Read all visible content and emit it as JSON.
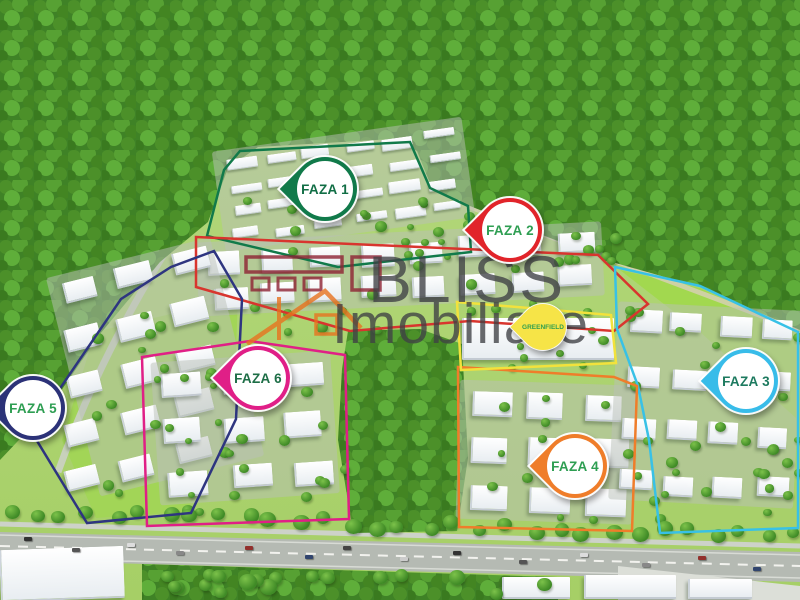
{
  "map": {
    "description": "Aerial masterplan render of Greenfield residential complex with phase markers",
    "watermark": {
      "brand": "BLISS",
      "brand2": "Imobiliare"
    },
    "phases": [
      {
        "id": "faza-1",
        "label": "FAZA 1",
        "pin_color": "#117a4a",
        "label_color": "#116e45",
        "boundary_color": "#117a4a",
        "pin_tip": {
          "x": 325,
          "y": 234
        },
        "boundary": [
          [
            240,
            151
          ],
          [
            410,
            142
          ],
          [
            430,
            188
          ],
          [
            468,
            206
          ],
          [
            471,
            252
          ],
          [
            338,
            267
          ],
          [
            207,
            236
          ],
          [
            224,
            170
          ]
        ]
      },
      {
        "id": "faza-2",
        "label": "FAZA 2",
        "pin_color": "#e1242a",
        "label_color": "#2e9e52",
        "boundary_color": "#d8352e",
        "pin_tip": {
          "x": 510,
          "y": 275
        },
        "boundary": [
          [
            196,
            237
          ],
          [
            598,
            255
          ],
          [
            648,
            304
          ],
          [
            614,
            331
          ],
          [
            470,
            321
          ],
          [
            350,
            331
          ],
          [
            196,
            287
          ]
        ]
      },
      {
        "id": "faza-3",
        "label": "FAZA 3",
        "pin_color": "#38bce9",
        "label_color": "#1d7a5f",
        "boundary_color": "#38c1e6",
        "pin_tip": {
          "x": 746,
          "y": 426
        },
        "boundary": [
          [
            615,
            267
          ],
          [
            700,
            286
          ],
          [
            798,
            332
          ],
          [
            798,
            528
          ],
          [
            660,
            533
          ],
          [
            649,
            440
          ],
          [
            638,
            386
          ],
          [
            617,
            329
          ]
        ]
      },
      {
        "id": "faza-4",
        "label": "FAZA 4",
        "pin_color": "#ef7d2a",
        "label_color": "#2e9e52",
        "boundary_color": "#ef7d2a",
        "pin_tip": {
          "x": 575,
          "y": 511
        },
        "boundary": [
          [
            458,
            367
          ],
          [
            614,
            377
          ],
          [
            637,
            386
          ],
          [
            632,
            531
          ],
          [
            459,
            527
          ]
        ]
      },
      {
        "id": "faza-5",
        "label": "FAZA 5",
        "pin_color": "#2c3278",
        "label_color": "#2e9e52",
        "boundary_color": "#2e3580",
        "pin_tip": {
          "x": 33,
          "y": 453
        },
        "boundary": [
          [
            214,
            251
          ],
          [
            242,
            299
          ],
          [
            236,
            419
          ],
          [
            191,
            513
          ],
          [
            87,
            523
          ],
          [
            31,
            431
          ],
          [
            121,
            299
          ],
          [
            171,
            267
          ]
        ]
      },
      {
        "id": "faza-6",
        "label": "FAZA 6",
        "pin_color": "#e01f87",
        "label_color": "#1d6e46",
        "boundary_color": "#e01f86",
        "pin_tip": {
          "x": 258,
          "y": 423
        },
        "boundary": [
          [
            142,
            357
          ],
          [
            250,
            341
          ],
          [
            345,
            355
          ],
          [
            349,
            519
          ],
          [
            147,
            526
          ]
        ]
      }
    ],
    "landmark": {
      "id": "greenfield",
      "label": "GREENFIELD",
      "pin_color": "#f6e447",
      "label_color": "#2e9e4f",
      "boundary_color": "#f2e23c",
      "pin_tip": {
        "x": 543,
        "y": 359
      },
      "boundary": [
        [
          457,
          302
        ],
        [
          611,
          315
        ],
        [
          616,
          363
        ],
        [
          461,
          370
        ]
      ]
    },
    "environment": {
      "forest_color": "#3f8226",
      "grass_color": "#aed172",
      "lawn_color": "#a2d557",
      "road_color": "#b5bab3",
      "logo_building_color": "#8e2233",
      "logo_house_color": "#e8731f"
    }
  }
}
